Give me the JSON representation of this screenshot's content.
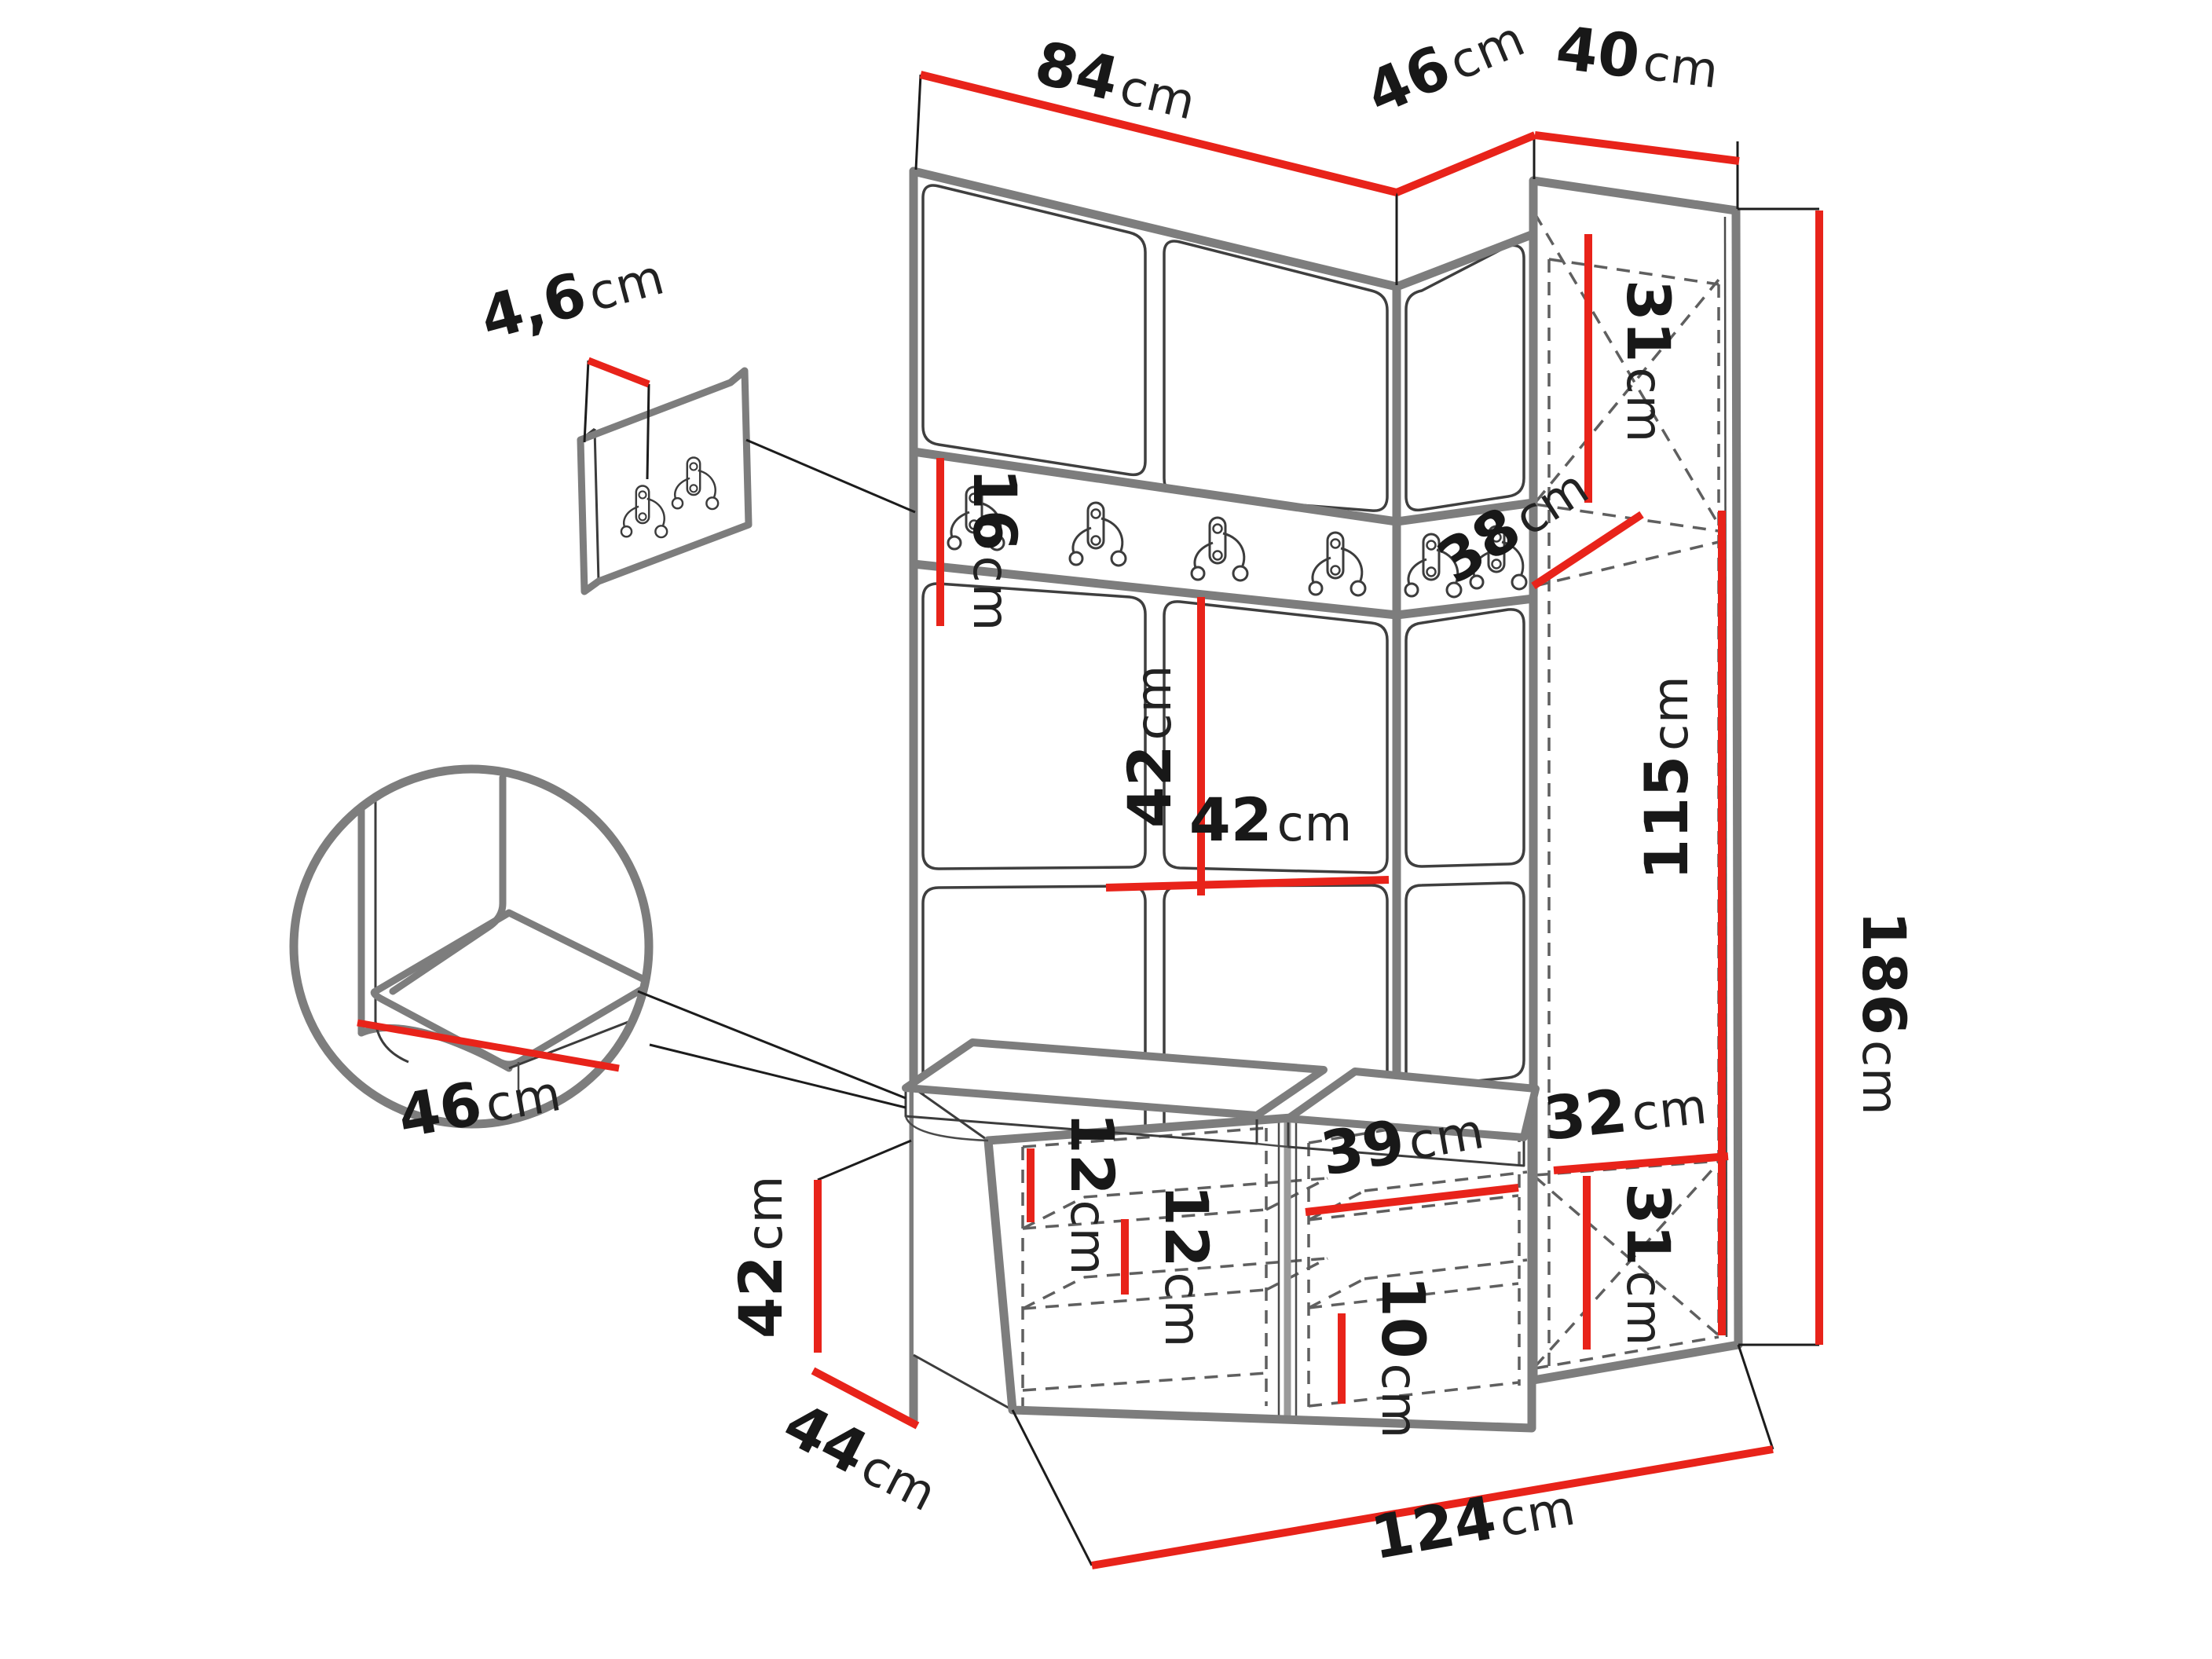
{
  "diagram": {
    "kind": "furniture-technical-drawing",
    "subject": "hallway set: upholstered panel wall with hook rail, tall corner wardrobe cabinet and shoe bench with seat cushions",
    "unit_default": "cm"
  },
  "colors": {
    "dimension_red": "#e8231a",
    "outline_gray": "#7d7d7d",
    "line_dark": "#3c3c3c",
    "hidden_dash_gray": "#5f5f5f",
    "text_black": "#181818",
    "background": "#ffffff"
  },
  "elements": {
    "rail_hook_count": 6,
    "small_panel_hook_count": 2,
    "seat_cushion_count": 2,
    "detail_views": [
      "wall-hook-panel-closeup",
      "seat-cushion-corner-circle"
    ]
  },
  "dimensions": {
    "top_width_main": {
      "value": "84",
      "unit": "cm"
    },
    "top_width_angled": {
      "value": "46",
      "unit": "cm"
    },
    "top_width_cabinet": {
      "value": "40",
      "unit": "cm"
    },
    "hook_panel_thickness": {
      "value": "4,6",
      "unit": "cm"
    },
    "rail_height": {
      "value": "16",
      "unit": "cm"
    },
    "panel_height": {
      "value": "42",
      "unit": "cm"
    },
    "panel_width": {
      "value": "42",
      "unit": "cm"
    },
    "cabinet_top_compartment_height": {
      "value": "31",
      "unit": "cm"
    },
    "cabinet_depth": {
      "value": "38",
      "unit": "cm"
    },
    "cabinet_interior_height": {
      "value": "115",
      "unit": "cm"
    },
    "total_height": {
      "value": "186",
      "unit": "cm"
    },
    "bench_shelf_gap_top": {
      "value": "12",
      "unit": "cm"
    },
    "bench_shelf_gap_mid": {
      "value": "12",
      "unit": "cm"
    },
    "bench_shelf_width": {
      "value": "39",
      "unit": "cm"
    },
    "bench_shelf_gap_bottom": {
      "value": "10",
      "unit": "cm"
    },
    "cabinet_bottom_width": {
      "value": "32",
      "unit": "cm"
    },
    "cabinet_bottom_compartment_height": {
      "value": "31",
      "unit": "cm"
    },
    "bench_height": {
      "value": "42",
      "unit": "cm"
    },
    "bench_depth": {
      "value": "44",
      "unit": "cm"
    },
    "total_width": {
      "value": "124",
      "unit": "cm"
    },
    "seat_depth": {
      "value": "46",
      "unit": "cm"
    }
  }
}
